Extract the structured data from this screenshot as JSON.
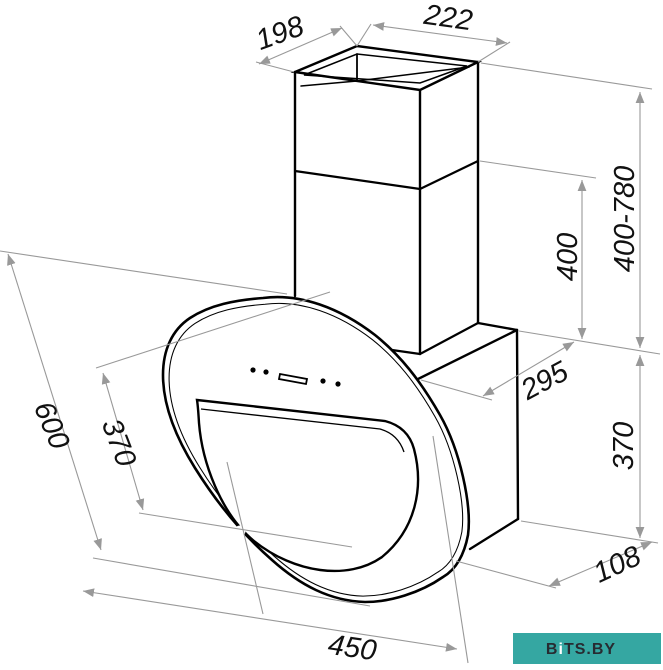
{
  "drawing": {
    "dims": {
      "chimney_top_width": "198",
      "chimney_top_depth": "222",
      "chimney_height_range": "400-780",
      "chimney_section_height": "400",
      "body_depth": "295",
      "body_height": "370",
      "body_bottom_depth": "108",
      "panel_diagonal_height": "600",
      "glass_diagonal_height": "370",
      "panel_width": "450"
    },
    "watermark": {
      "part_b": "B",
      "part_i": "i",
      "part_rest": "TS.BY"
    },
    "colors": {
      "line": "#000000",
      "dim_line": "#999999",
      "label": "#111111",
      "watermark_bg": "#35a7a2",
      "watermark_text": "#272b31",
      "watermark_i": "#ffffff"
    }
  }
}
